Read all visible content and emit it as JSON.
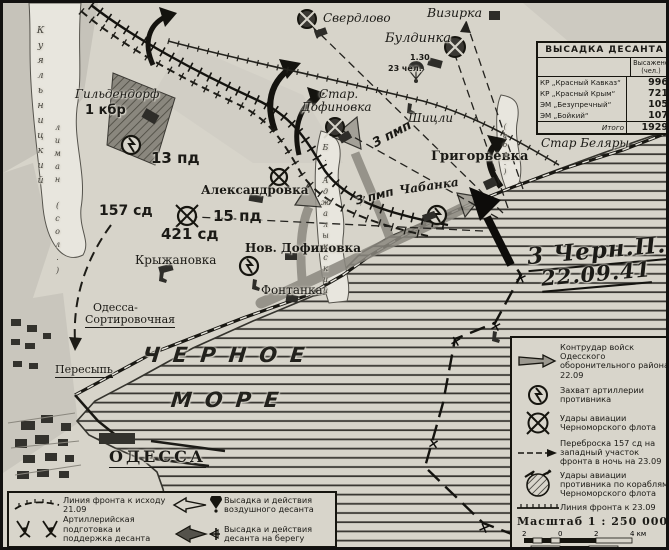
{
  "table": {
    "title": "ВЫСАДКА ДЕСАНТА",
    "value_header": "Высажено (чел.)",
    "rows": [
      {
        "name": "КР „Красный Кавказ“",
        "value": "996"
      },
      {
        "name": "КР „Красный Крым“",
        "value": "721"
      },
      {
        "name": "ЭМ „Безупречный“",
        "value": "105"
      },
      {
        "name": "ЭМ „Бойкий“",
        "value": "107"
      }
    ],
    "total_label": "Итого",
    "total_value": "1929"
  },
  "legend_right": {
    "items": [
      {
        "icon": "counterattack-arrow-icon",
        "label": "Контрудар войск Одесского оборонительного района 22.09"
      },
      {
        "icon": "artillery-capture-icon",
        "label": "Захват артиллерии противника"
      },
      {
        "icon": "navy-aviation-strike-icon",
        "label": "Удары авиации Черноморского флота"
      },
      {
        "icon": "troop-transfer-icon",
        "label": "Переброска 157 сд на западный участок фронта в ночь на 23.09"
      },
      {
        "icon": "enemy-aviation-strike-icon",
        "label": "Удары авиации противника по кораблям Черноморского флота"
      },
      {
        "icon": "front-line-23-09-icon",
        "label": "Линия фронта к 23.09"
      }
    ]
  },
  "scale": {
    "title": "Масштаб 1 : 250 000",
    "km_labels": [
      "2",
      "0",
      "2",
      "4 км"
    ],
    "mile_labels": [
      "1",
      "0",
      "1",
      "2 мили"
    ]
  },
  "legend_left": {
    "items": [
      {
        "icon": "front-line-21-09-icon",
        "label": "Линия фронта к исходу 21.09"
      },
      {
        "icon": "artillery-support-icon",
        "label": "Артиллерийская подготовка и поддержка десанта"
      },
      {
        "icon": "airborne-landing-icon",
        "label": "Высадка и действия воздушного десанта"
      },
      {
        "icon": "shore-landing-icon",
        "label": "Высадка и действия десанта на берегу"
      }
    ]
  },
  "annotation": {
    "unit": "3 Черн.П.МП",
    "date": "22.09.41"
  },
  "airborne": {
    "time": "1.30",
    "men": "23 чел."
  },
  "map": {
    "route_x_symbol": "×",
    "labels": {
      "sverdlovo": "Свердлово",
      "vizirka": "Визирка",
      "buldinka": "Булдинка",
      "star": "Стар.",
      "dofinovka": "Дофиновка",
      "shitsli": "Шицли",
      "grigoryevka": "Григорьевка",
      "star_belyary": "Стар Беляры",
      "chabanka": "Чабанка",
      "aleksandrovka": "Александровка",
      "sd157": "157 сд",
      "pd15": "15 пд",
      "sd421": "421 сд",
      "pd13": "13 пд",
      "gildendorf": "Гильдендорф",
      "kbr1": "1 кбр",
      "nov_dofinovka": "Нов. Дофиновка",
      "kryzhanovka": "Крыжановка",
      "fontanka": "Фонтанка",
      "odessa_sort1": "Одесса-",
      "odessa_sort2": "Сортировочная",
      "peresyp": "Пересыпь",
      "sea1": "ЧЕРНОЕ",
      "sea2": "МОРЕ",
      "odessa": "ОДЕССА",
      "pmp3_a": "3 пмп",
      "pmp3_b": "3 пмп",
      "kuyalnik_liman": "Куяльницкий",
      "kuyalnik_liman2": "лиман (сол.)",
      "adzhalyk_liman": "Б. Аджалыкский",
      "sol_small": "(сол.)"
    }
  }
}
